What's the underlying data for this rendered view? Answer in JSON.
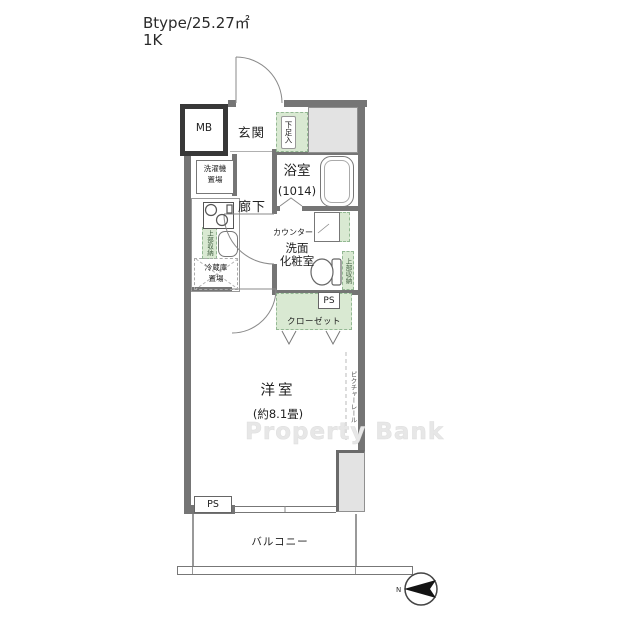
{
  "header": {
    "plan_type": "Btype/25.27㎡",
    "layout": "1K"
  },
  "labels": {
    "mb": "MB",
    "entrance": "玄関",
    "shoe_storage": "下足入",
    "washer_l1": "洗濯機",
    "washer_l2": "置場",
    "bathroom": "浴室",
    "bathroom_size": "(1014)",
    "hallway": "廊下",
    "counter": "カウンター",
    "vanity_l1": "洗面",
    "vanity_l2": "化粧室",
    "upper_storage": "上部収納",
    "fridge_l1": "冷蔵庫",
    "fridge_l2": "置場",
    "pipe_space": "PS",
    "closet": "クローゼット",
    "western_room": "洋室",
    "western_room_size": "(約8.1畳)",
    "picture_rail": "ピクチャーレール",
    "balcony": "バルコニー"
  },
  "watermark": "Property Bank",
  "compass": {
    "north": "N"
  },
  "colors": {
    "storage_green": "#d9e9d2",
    "wall_gray": "#757575",
    "outside_gray": "#e3e3e3",
    "watermark_gray": "#e7e7e7"
  }
}
